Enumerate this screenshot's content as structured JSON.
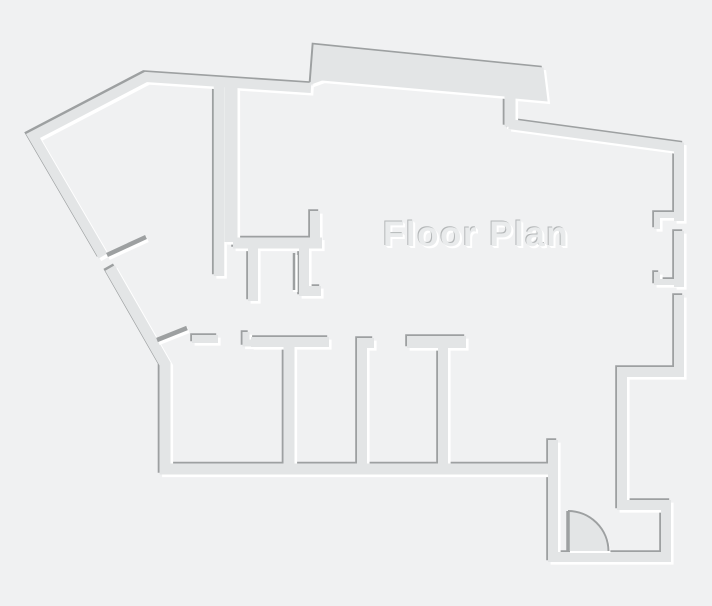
{
  "title": {
    "text": "Floor Plan"
  },
  "canvas": {
    "width": 712,
    "height": 606,
    "background": "#f0f1f2"
  },
  "colors": {
    "wall_fill": "#e3e5e6",
    "wall_edge": "#9da0a1",
    "wall_highlight": "#ffffff",
    "title_fill": "#e9ebec",
    "title_shadow_dark": "#b4b7b8",
    "title_shadow_light": "#ffffff"
  },
  "floor_plan": {
    "walls": [
      {
        "name": "wall-exterior-top-left",
        "pts": [
          [
            311,
            88
          ],
          [
            146,
            77
          ],
          [
            33,
            136
          ],
          [
            103,
            256
          ]
        ],
        "w": 10
      },
      {
        "name": "wall-exterior-left-lower",
        "pts": [
          [
            110,
            268
          ],
          [
            165,
            364
          ],
          [
            165,
            469
          ],
          [
            553,
            469
          ]
        ],
        "w": 11
      },
      {
        "name": "wall-exterior-top-right",
        "pts": [
          [
            509,
            124
          ],
          [
            679,
            147
          ],
          [
            679,
            221
          ]
        ],
        "w": 10
      },
      {
        "name": "wall-exterior-right-mid",
        "pts": [
          [
            679,
            231
          ],
          [
            679,
            287
          ]
        ],
        "w": 10
      },
      {
        "name": "wall-exterior-right-lower",
        "pts": [
          [
            679,
            295
          ],
          [
            679,
            372
          ],
          [
            622,
            372
          ],
          [
            622,
            505
          ],
          [
            666,
            505
          ],
          [
            666,
            557
          ],
          [
            553,
            557
          ],
          [
            553,
            440
          ]
        ],
        "w": 10
      },
      {
        "name": "wall-corridor-a",
        "pts": [
          [
            219,
            82
          ],
          [
            219,
            276
          ]
        ],
        "w": 10.5
      },
      {
        "name": "wall-corridor-b",
        "pts": [
          [
            231,
            82
          ],
          [
            231,
            242
          ]
        ],
        "w": 13
      },
      {
        "name": "wall-closet-top",
        "pts": [
          [
            233,
            243
          ],
          [
            322,
            243
          ]
        ],
        "w": 11
      },
      {
        "name": "wall-closet-stub-up",
        "pts": [
          [
            315,
            211
          ],
          [
            315,
            245
          ]
        ],
        "w": 10
      },
      {
        "name": "wall-closet-stub-down",
        "pts": [
          [
            253,
            245
          ],
          [
            253,
            301
          ]
        ],
        "w": 10
      },
      {
        "name": "wall-closet-l",
        "pts": [
          [
            304,
            246
          ],
          [
            304,
            291
          ],
          [
            321,
            291
          ]
        ],
        "w": 10
      },
      {
        "name": "wall-door-jamb-left",
        "pts": [
          [
            192,
            339
          ],
          [
            218,
            339
          ]
        ],
        "w": 8
      },
      {
        "name": "wall-door-jamb-step",
        "pts": [
          [
            246,
            332
          ],
          [
            246,
            343
          ],
          [
            257,
            343
          ]
        ],
        "w": 7
      },
      {
        "name": "wall-header-left",
        "pts": [
          [
            251,
            342
          ],
          [
            329,
            342
          ]
        ],
        "w": 10
      },
      {
        "name": "wall-room-divider-1",
        "pts": [
          [
            289,
            341
          ],
          [
            289,
            468
          ]
        ],
        "w": 11
      },
      {
        "name": "wall-room-divider-2",
        "pts": [
          [
            374,
            343
          ],
          [
            362,
            343
          ],
          [
            362,
            468
          ]
        ],
        "w": 10
      },
      {
        "name": "wall-header-right",
        "pts": [
          [
            407,
            342
          ],
          [
            466,
            342
          ]
        ],
        "w": 12
      },
      {
        "name": "wall-room-divider-3",
        "pts": [
          [
            443,
            344
          ],
          [
            443,
            468
          ]
        ],
        "w": 10
      },
      {
        "name": "window-notch-top",
        "pts": [
          [
            676,
            215
          ],
          [
            657,
            215
          ],
          [
            657,
            229
          ]
        ],
        "w": 6
      },
      {
        "name": "window-notch-bottom",
        "pts": [
          [
            657,
            272
          ],
          [
            657,
            282
          ],
          [
            676,
            282
          ]
        ],
        "w": 6
      }
    ],
    "polygons": [
      {
        "name": "wall-top-bump",
        "pts": [
          [
            311,
            84
          ],
          [
            314,
            45
          ],
          [
            543,
            68
          ],
          [
            547,
            101
          ],
          [
            515,
            98
          ],
          [
            515,
            127
          ],
          [
            505,
            126
          ],
          [
            505,
            96
          ],
          [
            322,
            80
          ]
        ]
      }
    ],
    "thin_lines": [
      {
        "name": "door-leaf-upper-left",
        "pts": [
          [
            107,
            255
          ],
          [
            146,
            237
          ]
        ],
        "w": 4.5
      },
      {
        "name": "door-leaf-mid-left",
        "pts": [
          [
            157,
            340
          ],
          [
            187,
            328
          ]
        ],
        "w": 4.5
      },
      {
        "name": "closet-thin-line",
        "pts": [
          [
            294,
            253
          ],
          [
            294,
            290
          ]
        ],
        "w": 2.5
      }
    ],
    "door": {
      "hinge": [
        568,
        551
      ],
      "leaf_tip": [
        568,
        511
      ],
      "arc_end": [
        608.5,
        551
      ],
      "r": 40.5
    }
  }
}
